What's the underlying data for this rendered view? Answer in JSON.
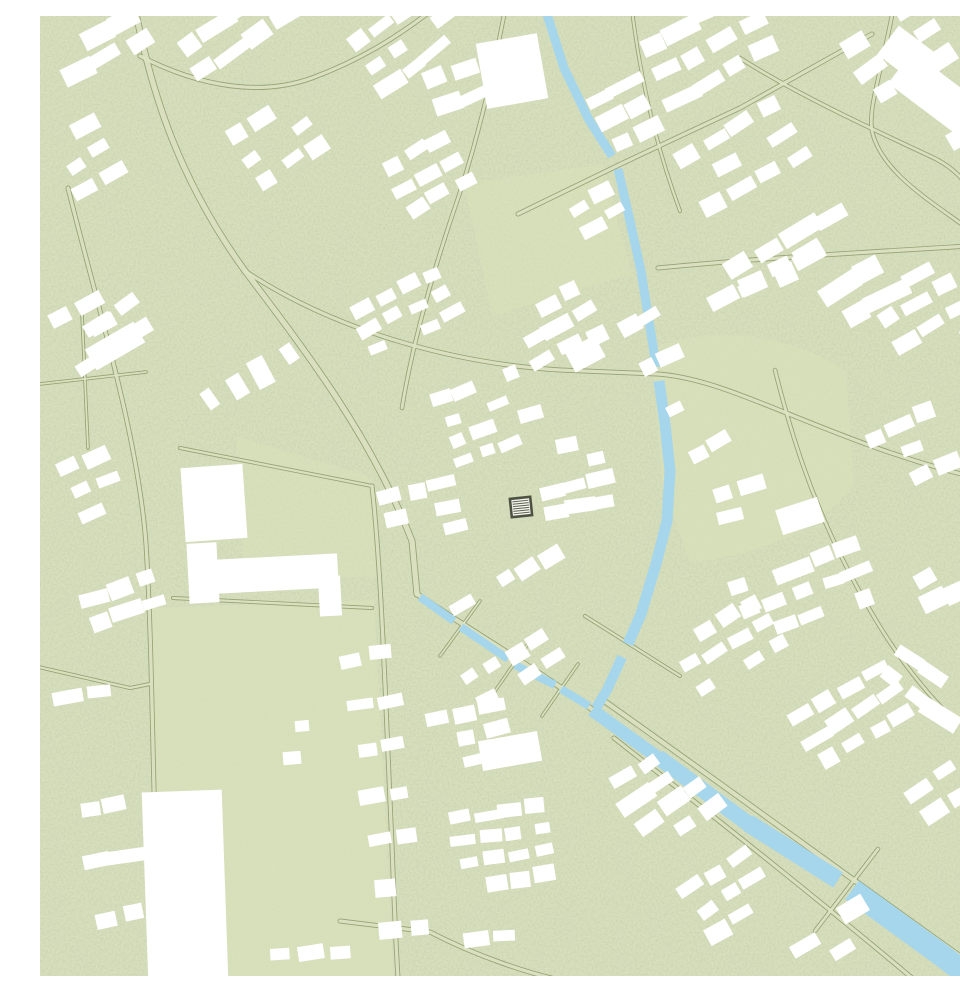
{
  "map": {
    "type": "architectural-site-plan",
    "canvas": {
      "width": 960,
      "height": 960
    },
    "colors": {
      "base": "#d8dfbc",
      "speckle_fine": "#8ba06f",
      "speckle_coarse": "#a8ba85",
      "road_edge": "#94a274",
      "road_fill": "#dde4c3",
      "water": "#a6d6ec",
      "building": "#ffffff",
      "field": "#d9e1ba"
    },
    "parks": [
      {
        "d": "M110,592 L334,584 L354,962 L112,962 Z",
        "opacity": 0.7
      },
      {
        "d": "M612,332 C676,306 762,322 806,356 L814,468 C776,520 704,542 650,546 L622,470 Z",
        "opacity": 0.65
      },
      {
        "d": "M424,168 L562,148 L592,258 L452,300 Z",
        "opacity": 0.5
      },
      {
        "d": "M196,420 L334,462 L336,560 L205,568 Z",
        "opacity": 0.5
      }
    ],
    "roads": [
      {
        "d": "M95,-8 C112,80 140,165 205,255 C268,338 332,422 372,525 L377,578",
        "w": 7
      },
      {
        "d": "M377,578 C420,608 500,655 557,697",
        "w": 6
      },
      {
        "d": "M560,682 C660,752 800,855 945,958",
        "w": 6
      },
      {
        "d": "M574,722 C660,790 760,868 872,962",
        "w": 5
      },
      {
        "d": "M28,172 C58,292 98,420 106,528 C113,640 112,770 120,962",
        "w": 5
      },
      {
        "d": "M100,40 C162,72 222,80 272,62 C318,45 356,22 392,-6",
        "w": 5
      },
      {
        "d": "M465,-6 C452,62 436,132 412,200 C390,266 372,330 362,392",
        "w": 4.5
      },
      {
        "d": "M205,255 C300,318 420,348 520,354 L618,358 C700,364 790,430 962,468",
        "w": 5
      },
      {
        "d": "M478,198 L583,147 L700,92 L832,18",
        "w": 5
      },
      {
        "d": "M853,-6 C841,58 828,92 832,115 C842,160 900,190 940,222",
        "w": 4.5
      },
      {
        "d": "M700,42 C762,82 852,122 896,143 C932,162 946,196 938,224",
        "w": 4.5
      },
      {
        "d": "M618,252 C720,242 830,236 962,228",
        "w": 5
      },
      {
        "d": "M735,354 C752,422 772,482 802,542 C832,602 862,650 902,692",
        "w": 4.5
      },
      {
        "d": "M140,432 L332,470",
        "w": 4
      },
      {
        "d": "M133,582 L332,592",
        "w": 4
      },
      {
        "d": "M332,470 C342,560 346,700 352,830 C354,884 356,930 358,962",
        "w": 5
      },
      {
        "d": "M-6,650 L90,672 L110,668",
        "w": 4
      },
      {
        "d": "M300,905 L390,916 C440,942 492,958 520,964",
        "w": 5
      },
      {
        "d": "M838,833 L775,915",
        "w": 4.5
      },
      {
        "d": "M545,600 L640,660",
        "w": 4
      },
      {
        "d": "M400,640 L440,585",
        "w": 3.5
      },
      {
        "d": "M455,675 L492,622",
        "w": 3.5
      },
      {
        "d": "M502,700 L538,648",
        "w": 3.5
      },
      {
        "d": "M592,-6 C600,60 616,130 640,195",
        "w": 4
      },
      {
        "d": "M42,298 L48,432",
        "w": 3.5
      },
      {
        "d": "M0,368 L106,356",
        "w": 3.5
      }
    ],
    "water": [
      {
        "d": "M505,-8 L524,52 L549,104 L572,140",
        "w": 9
      },
      {
        "d": "M578,153 L590,205 L601,255 L613,330 L616,351",
        "w": 9
      },
      {
        "d": "M619,365 L625,408 L630,455 L627,505 L616,548 L601,598 L588,628",
        "w": 11
      },
      {
        "d": "M582,641 L567,674 L556,692",
        "w": 10
      },
      {
        "d": "M380,581 L414,605",
        "w": 8
      },
      {
        "d": "M421,611 L468,643",
        "w": 8
      },
      {
        "d": "M475,649 L515,669",
        "w": 8
      },
      {
        "d": "M521,673 L549,690",
        "w": 8
      },
      {
        "d": "M552,694 L620,743",
        "w": 13
      },
      {
        "d": "M618,741 L710,809",
        "w": 16
      },
      {
        "d": "M708,807 L798,864",
        "w": 18
      },
      {
        "d": "M812,874 L900,938 L975,995",
        "w": 23
      }
    ],
    "buildings": {
      "clusters": [
        {
          "x": 25,
          "y": 35,
          "rot": -30,
          "rows": 2,
          "cols": 3,
          "w": 26,
          "h": 16,
          "gx": 34,
          "gy": 27,
          "skip": 0.1
        },
        {
          "x": 20,
          "y": 128,
          "rot": -30,
          "rows": 3,
          "cols": 2,
          "w": 23,
          "h": 14,
          "gx": 31,
          "gy": 25,
          "skip": 0.12
        },
        {
          "x": 32,
          "y": 262,
          "rot": -32,
          "rows": 4,
          "cols": 2,
          "w": 24,
          "h": 15,
          "gx": 32,
          "gy": 27,
          "skip": 0.15
        },
        {
          "x": 148,
          "y": 28,
          "rot": -34,
          "rows": 2,
          "cols": 4,
          "w": 24,
          "h": 15,
          "gx": 32,
          "gy": 30,
          "skip": 0.12
        },
        {
          "x": 198,
          "y": 118,
          "rot": -33,
          "rows": 3,
          "cols": 3,
          "w": 22,
          "h": 14,
          "gx": 30,
          "gy": 26,
          "skip": 0.15
        },
        {
          "x": 318,
          "y": 28,
          "rot": -36,
          "rows": 3,
          "cols": 4,
          "w": 22,
          "h": 14,
          "gx": 29,
          "gy": 25,
          "skip": 0.15
        },
        {
          "x": 352,
          "y": 150,
          "rot": -30,
          "rows": 3,
          "cols": 3,
          "w": 20,
          "h": 13,
          "gx": 27,
          "gy": 24,
          "skip": 0.2
        },
        {
          "x": 396,
          "y": 62,
          "rot": -22,
          "rows": 2,
          "cols": 2,
          "w": 24,
          "h": 15,
          "gx": 32,
          "gy": 28,
          "skip": 0.1
        },
        {
          "x": 610,
          "y": 28,
          "rot": -28,
          "rows": 3,
          "cols": 4,
          "w": 25,
          "h": 15,
          "gx": 33,
          "gy": 30,
          "skip": 0.12
        },
        {
          "x": 646,
          "y": 140,
          "rot": -30,
          "rows": 3,
          "cols": 4,
          "w": 24,
          "h": 15,
          "gx": 32,
          "gy": 28,
          "skip": 0.15
        },
        {
          "x": 700,
          "y": 250,
          "rot": -28,
          "rows": 2,
          "cols": 4,
          "w": 26,
          "h": 16,
          "gx": 34,
          "gy": 26,
          "skip": 0.12
        },
        {
          "x": 812,
          "y": 28,
          "rot": -32,
          "rows": 3,
          "cols": 3,
          "w": 26,
          "h": 16,
          "gx": 34,
          "gy": 30,
          "skip": 0.12
        },
        {
          "x": 800,
          "y": 272,
          "rot": -30,
          "rows": 2,
          "cols": 3,
          "w": 28,
          "h": 17,
          "gx": 36,
          "gy": 30,
          "skip": 0.1
        },
        {
          "x": 930,
          "y": 118,
          "rot": -32,
          "rows": 4,
          "cols": 1,
          "w": 26,
          "h": 16,
          "gx": 34,
          "gy": 34,
          "skip": 0.15
        },
        {
          "x": 320,
          "y": 292,
          "rot": -26,
          "rows": 3,
          "cols": 4,
          "w": 20,
          "h": 13,
          "gx": 27,
          "gy": 23,
          "skip": 0.18
        },
        {
          "x": 402,
          "y": 382,
          "rot": -20,
          "rows": 4,
          "cols": 4,
          "w": 19,
          "h": 12,
          "gx": 25,
          "gy": 22,
          "skip": 0.2
        },
        {
          "x": 352,
          "y": 482,
          "rot": -14,
          "rows": 3,
          "cols": 3,
          "w": 20,
          "h": 13,
          "gx": 27,
          "gy": 23,
          "skip": 0.2
        },
        {
          "x": 482,
          "y": 302,
          "rot": -28,
          "rows": 3,
          "cols": 3,
          "w": 21,
          "h": 13,
          "gx": 28,
          "gy": 24,
          "skip": 0.15
        },
        {
          "x": 502,
          "y": 432,
          "rot": -12,
          "rows": 4,
          "cols": 3,
          "w": 20,
          "h": 13,
          "gx": 26,
          "gy": 22,
          "skip": 0.2
        },
        {
          "x": 565,
          "y": 268,
          "rot": -28,
          "rows": 5,
          "cols": 2,
          "w": 20,
          "h": 13,
          "gx": 26,
          "gy": 48,
          "skip": 0.2
        },
        {
          "x": 682,
          "y": 282,
          "rot": -28,
          "rows": 1,
          "cols": 4,
          "w": 24,
          "h": 15,
          "gx": 32,
          "gy": 26,
          "skip": 0.1
        },
        {
          "x": 850,
          "y": 302,
          "rot": -30,
          "rows": 3,
          "cols": 3,
          "w": 24,
          "h": 15,
          "gx": 32,
          "gy": 28,
          "skip": 0.15
        },
        {
          "x": 832,
          "y": 422,
          "rot": -24,
          "rows": 3,
          "cols": 3,
          "w": 23,
          "h": 14,
          "gx": 30,
          "gy": 26,
          "skip": 0.15
        },
        {
          "x": 682,
          "y": 478,
          "rot": -15,
          "rows": 2,
          "cols": 3,
          "w": 22,
          "h": 14,
          "gx": 29,
          "gy": 25,
          "skip": 0.15
        },
        {
          "x": 700,
          "y": 572,
          "rot": -20,
          "rows": 3,
          "cols": 5,
          "w": 22,
          "h": 14,
          "gx": 29,
          "gy": 25,
          "skip": 0.18
        },
        {
          "x": 882,
          "y": 562,
          "rot": -28,
          "rows": 2,
          "cols": 3,
          "w": 24,
          "h": 15,
          "gx": 31,
          "gy": 27,
          "skip": 0.1
        },
        {
          "x": 20,
          "y": 302,
          "rot": -30,
          "rows": 3,
          "cols": 2,
          "w": 24,
          "h": 15,
          "gx": 31,
          "gy": 27,
          "skip": 0.15
        },
        {
          "x": 30,
          "y": 452,
          "rot": -24,
          "rows": 3,
          "cols": 2,
          "w": 23,
          "h": 14,
          "gx": 30,
          "gy": 26,
          "skip": 0.15
        },
        {
          "x": 52,
          "y": 582,
          "rot": -18,
          "rows": 2,
          "cols": 3,
          "w": 22,
          "h": 14,
          "gx": 29,
          "gy": 25,
          "skip": 0.15
        },
        {
          "x": 28,
          "y": 682,
          "rot": -10,
          "rows": 5,
          "cols": 2,
          "w": 22,
          "h": 14,
          "gx": 29,
          "gy": 56,
          "skip": 0.25
        },
        {
          "x": 312,
          "y": 642,
          "rot": -8,
          "rows": 7,
          "cols": 2,
          "w": 21,
          "h": 14,
          "gx": 30,
          "gy": 46,
          "skip": 0.2
        },
        {
          "x": 395,
          "y": 702,
          "rot": -12,
          "rows": 3,
          "cols": 3,
          "w": 22,
          "h": 14,
          "gx": 29,
          "gy": 25,
          "skip": 0.15
        },
        {
          "x": 420,
          "y": 802,
          "rot": -8,
          "rows": 4,
          "cols": 4,
          "w": 20,
          "h": 13,
          "gx": 26,
          "gy": 23,
          "skip": 0.2
        },
        {
          "x": 378,
          "y": 930,
          "rot": -6,
          "rows": 1,
          "cols": 4,
          "w": 22,
          "h": 14,
          "gx": 29,
          "gy": 24,
          "skip": 0.1
        },
        {
          "x": 640,
          "y": 628,
          "rot": -30,
          "rows": 3,
          "cols": 4,
          "w": 21,
          "h": 13,
          "gx": 28,
          "gy": 24,
          "skip": 0.15
        },
        {
          "x": 762,
          "y": 700,
          "rot": -32,
          "rows": 3,
          "cols": 4,
          "w": 22,
          "h": 14,
          "gx": 29,
          "gy": 25,
          "skip": 0.15
        },
        {
          "x": 880,
          "y": 772,
          "rot": -32,
          "rows": 2,
          "cols": 3,
          "w": 24,
          "h": 15,
          "gx": 31,
          "gy": 27,
          "skip": 0.1
        },
        {
          "x": 582,
          "y": 762,
          "rot": -33,
          "rows": 4,
          "cols": 3,
          "w": 22,
          "h": 14,
          "gx": 29,
          "gy": 25,
          "skip": 0.15
        },
        {
          "x": 652,
          "y": 872,
          "rot": -33,
          "rows": 3,
          "cols": 3,
          "w": 22,
          "h": 14,
          "gx": 29,
          "gy": 25,
          "skip": 0.15
        },
        {
          "x": 762,
          "y": 930,
          "rot": -34,
          "rows": 2,
          "cols": 3,
          "w": 24,
          "h": 15,
          "gx": 31,
          "gy": 26,
          "skip": 0.1
        },
        {
          "x": 422,
          "y": 590,
          "rot": -30,
          "rows": 1,
          "cols": 5,
          "w": 20,
          "h": 13,
          "gx": 26,
          "gy": 22,
          "skip": 0.1
        },
        {
          "x": 432,
          "y": 662,
          "rot": -30,
          "rows": 2,
          "cols": 4,
          "w": 20,
          "h": 13,
          "gx": 26,
          "gy": 23,
          "skip": 0.15
        },
        {
          "x": 945,
          "y": 342,
          "rot": -30,
          "rows": 6,
          "cols": 1,
          "w": 24,
          "h": 15,
          "gx": 31,
          "gy": 52,
          "skip": 0.2
        },
        {
          "x": 248,
          "y": 338,
          "rot": 59,
          "rows": 4,
          "cols": 1,
          "w": 24,
          "h": 15,
          "gx": 31,
          "gy": 30,
          "skip": 0.1
        },
        {
          "x": 560,
          "y": 80,
          "rot": -28,
          "rows": 3,
          "cols": 2,
          "w": 22,
          "h": 14,
          "gx": 29,
          "gy": 26,
          "skip": 0.15
        },
        {
          "x": 868,
          "y": 640,
          "rot": 35,
          "rows": 2,
          "cols": 3,
          "w": 24,
          "h": 15,
          "gx": 31,
          "gy": 27,
          "skip": 0.12
        },
        {
          "x": 240,
          "y": 940,
          "rot": -6,
          "rows": 1,
          "cols": 3,
          "w": 22,
          "h": 14,
          "gx": 29,
          "gy": 24,
          "skip": 0.2
        },
        {
          "x": 540,
          "y": 190,
          "rot": -30,
          "rows": 2,
          "cols": 2,
          "w": 20,
          "h": 13,
          "gx": 27,
          "gy": 24,
          "skip": 0.15
        }
      ],
      "singles": [
        {
          "x": 174,
          "y": 487,
          "w": 62,
          "h": 74,
          "rot": -4
        },
        {
          "x": 228,
          "y": 558,
          "w": 140,
          "h": 34,
          "rot": -3
        },
        {
          "x": 163,
          "y": 557,
          "w": 30,
          "h": 60,
          "rot": -3
        },
        {
          "x": 290,
          "y": 580,
          "w": 22,
          "h": 40,
          "rot": -3
        },
        {
          "x": 145,
          "y": 870,
          "w": 80,
          "h": 190,
          "rot": -2
        },
        {
          "x": 472,
          "y": 55,
          "w": 62,
          "h": 66,
          "rot": -10
        },
        {
          "x": 905,
          "y": 85,
          "w": 112,
          "h": 40,
          "rot": 37
        },
        {
          "x": 872,
          "y": 42,
          "w": 60,
          "h": 36,
          "rot": 37
        },
        {
          "x": 75,
          "y": 330,
          "w": 56,
          "h": 24,
          "rot": -30
        },
        {
          "x": 760,
          "y": 500,
          "w": 44,
          "h": 26,
          "rot": -18
        },
        {
          "x": 545,
          "y": 338,
          "w": 34,
          "h": 24,
          "rot": -28
        },
        {
          "x": 470,
          "y": 735,
          "w": 60,
          "h": 30,
          "rot": -10
        },
        {
          "x": 252,
          "y": 742,
          "w": 18,
          "h": 13,
          "rot": -5
        },
        {
          "x": 262,
          "y": 710,
          "w": 14,
          "h": 11,
          "rot": -5
        }
      ]
    },
    "highlight": {
      "cx": 481,
      "cy": 491,
      "w": 23,
      "h": 21,
      "rot": -6,
      "border": "#4e5243",
      "fill": "#f6f6f0",
      "hatch": "#5c604d",
      "hatch_lines": 6
    }
  }
}
